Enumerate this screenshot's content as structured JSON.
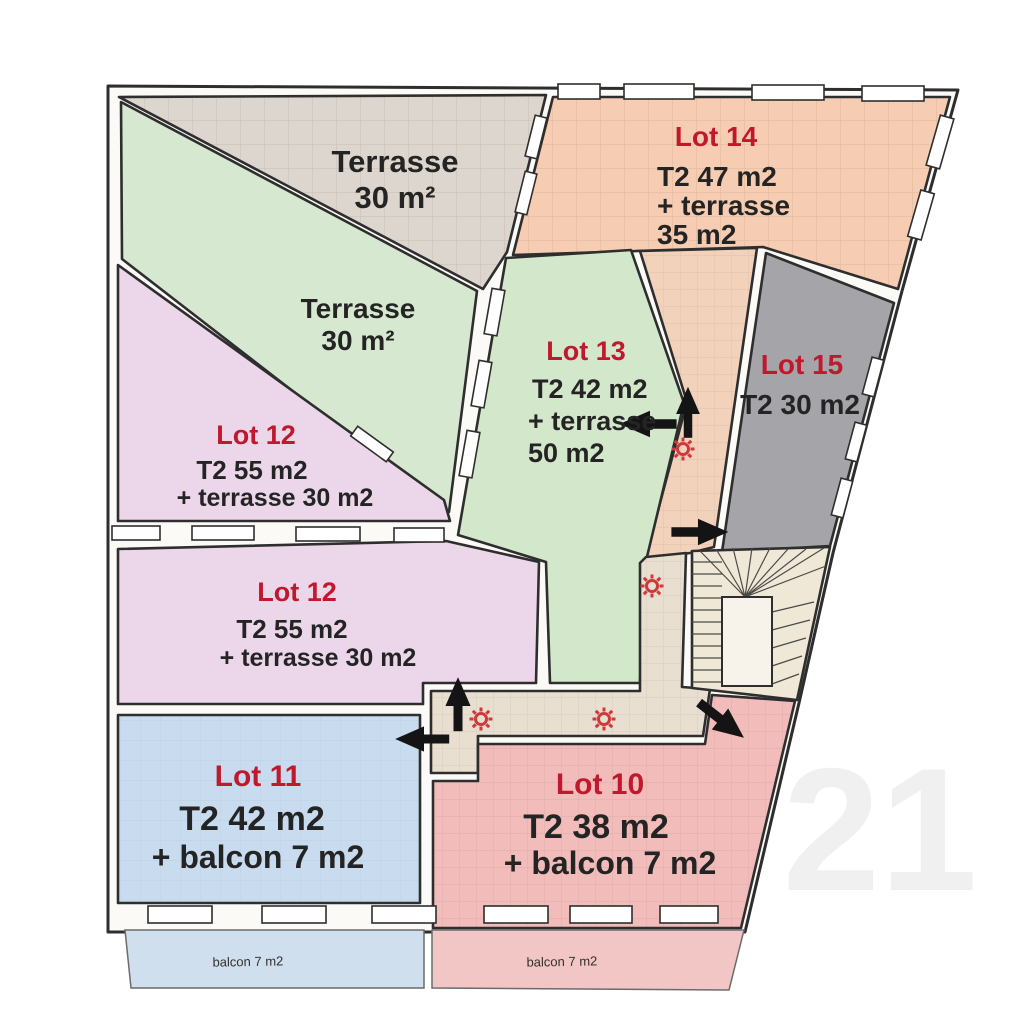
{
  "plan": {
    "kind": "floor-plan",
    "watermark": "21"
  },
  "colors": {
    "terrace_top": "#dcd6ce",
    "terrace_mid": "#d6e9d0",
    "lot14": "#f6cdb2",
    "hall_upper": "#f3d2bc",
    "lot13": "#d3e7cb",
    "lot15": "#a4a4a9",
    "lot12": "#ecd7ea",
    "lot11": "#c9dcef",
    "lot10": "#f2bcba",
    "corridor": "#e9dfd0",
    "stairs": "#efe8d6",
    "balcony_left": "#cfdfee",
    "balcony_right": "#f2c6c4",
    "label_red": "#c0182c",
    "label_dark": "#242424",
    "wall_line": "#2e2e2e",
    "light_point_red": "#ce3a3c"
  },
  "icons": {
    "door_arrow": "black-direction-arrow",
    "light_point": "red-sun-symbol"
  },
  "rooms": {
    "terrace_top": {
      "name": "Terrasse",
      "area": "30 m²"
    },
    "terrace_mid": {
      "name": "Terrasse",
      "area": "30 m²"
    },
    "lot14": {
      "name": "Lot 14",
      "line1": "T2 47 m2",
      "line2": "+ terrasse",
      "line3": "35 m2"
    },
    "lot13": {
      "name": "Lot 13",
      "line1": "T2 42 m2",
      "line2": "+ terrasse",
      "line3": "50 m2"
    },
    "lot15": {
      "name": "Lot 15",
      "line1": "T2 30 m2"
    },
    "lot12_upper": {
      "name": "Lot 12",
      "line1": "T2 55 m2",
      "line2": "+ terrasse 30 m2"
    },
    "lot12_lower": {
      "name": "Lot 12",
      "line1": "T2 55 m2",
      "line2": "+ terrasse 30 m2"
    },
    "lot11": {
      "name": "Lot 11",
      "line1": "T2 42 m2",
      "line2": "+ balcon 7 m2"
    },
    "lot10": {
      "name": "Lot 10",
      "line1": "T2 38 m2",
      "line2": "+ balcon 7 m2"
    }
  },
  "balconies": {
    "left": "balcon 7 m2",
    "right": "balcon 7 m2"
  }
}
